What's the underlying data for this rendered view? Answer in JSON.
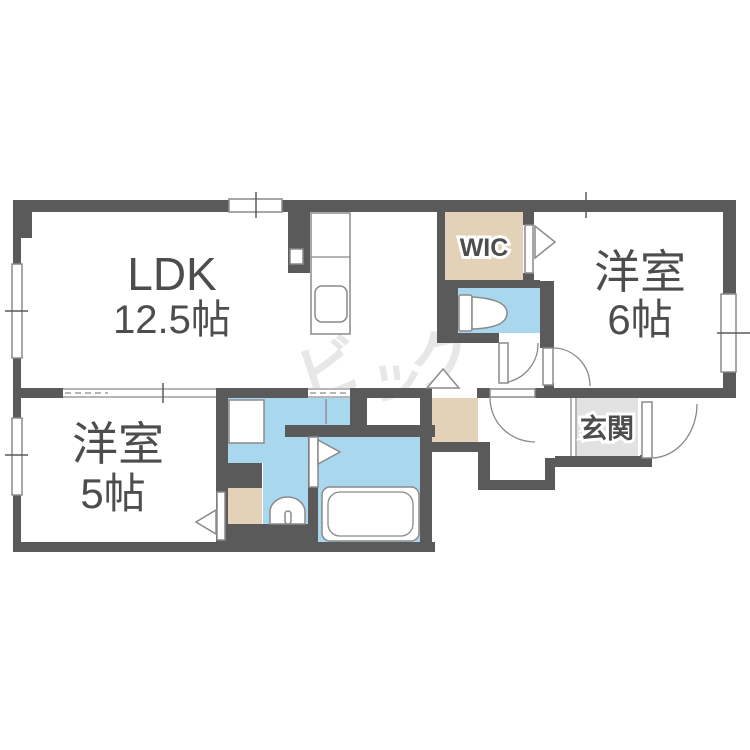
{
  "plan": {
    "rooms": {
      "ldk": {
        "name": "LDK",
        "size": "12.5帖"
      },
      "bedroom6": {
        "name": "洋室",
        "size": "6帖"
      },
      "bedroom5": {
        "name": "洋室",
        "size": "5帖"
      },
      "wic": {
        "label": "WIC"
      },
      "genkan": {
        "label": "玄関"
      }
    },
    "watermark": {
      "text": "ビッグ",
      "chars": [
        "ビ",
        "ッ",
        "グ"
      ]
    },
    "colors": {
      "wall": "#5a5a5a",
      "water": "#a9d7ee",
      "closet": "#e3d2b8",
      "genkan": "#e2e2e2",
      "text": "#4d4d4d",
      "fixture": "#8a8a8a",
      "watermark": "#e7e7e7"
    }
  }
}
